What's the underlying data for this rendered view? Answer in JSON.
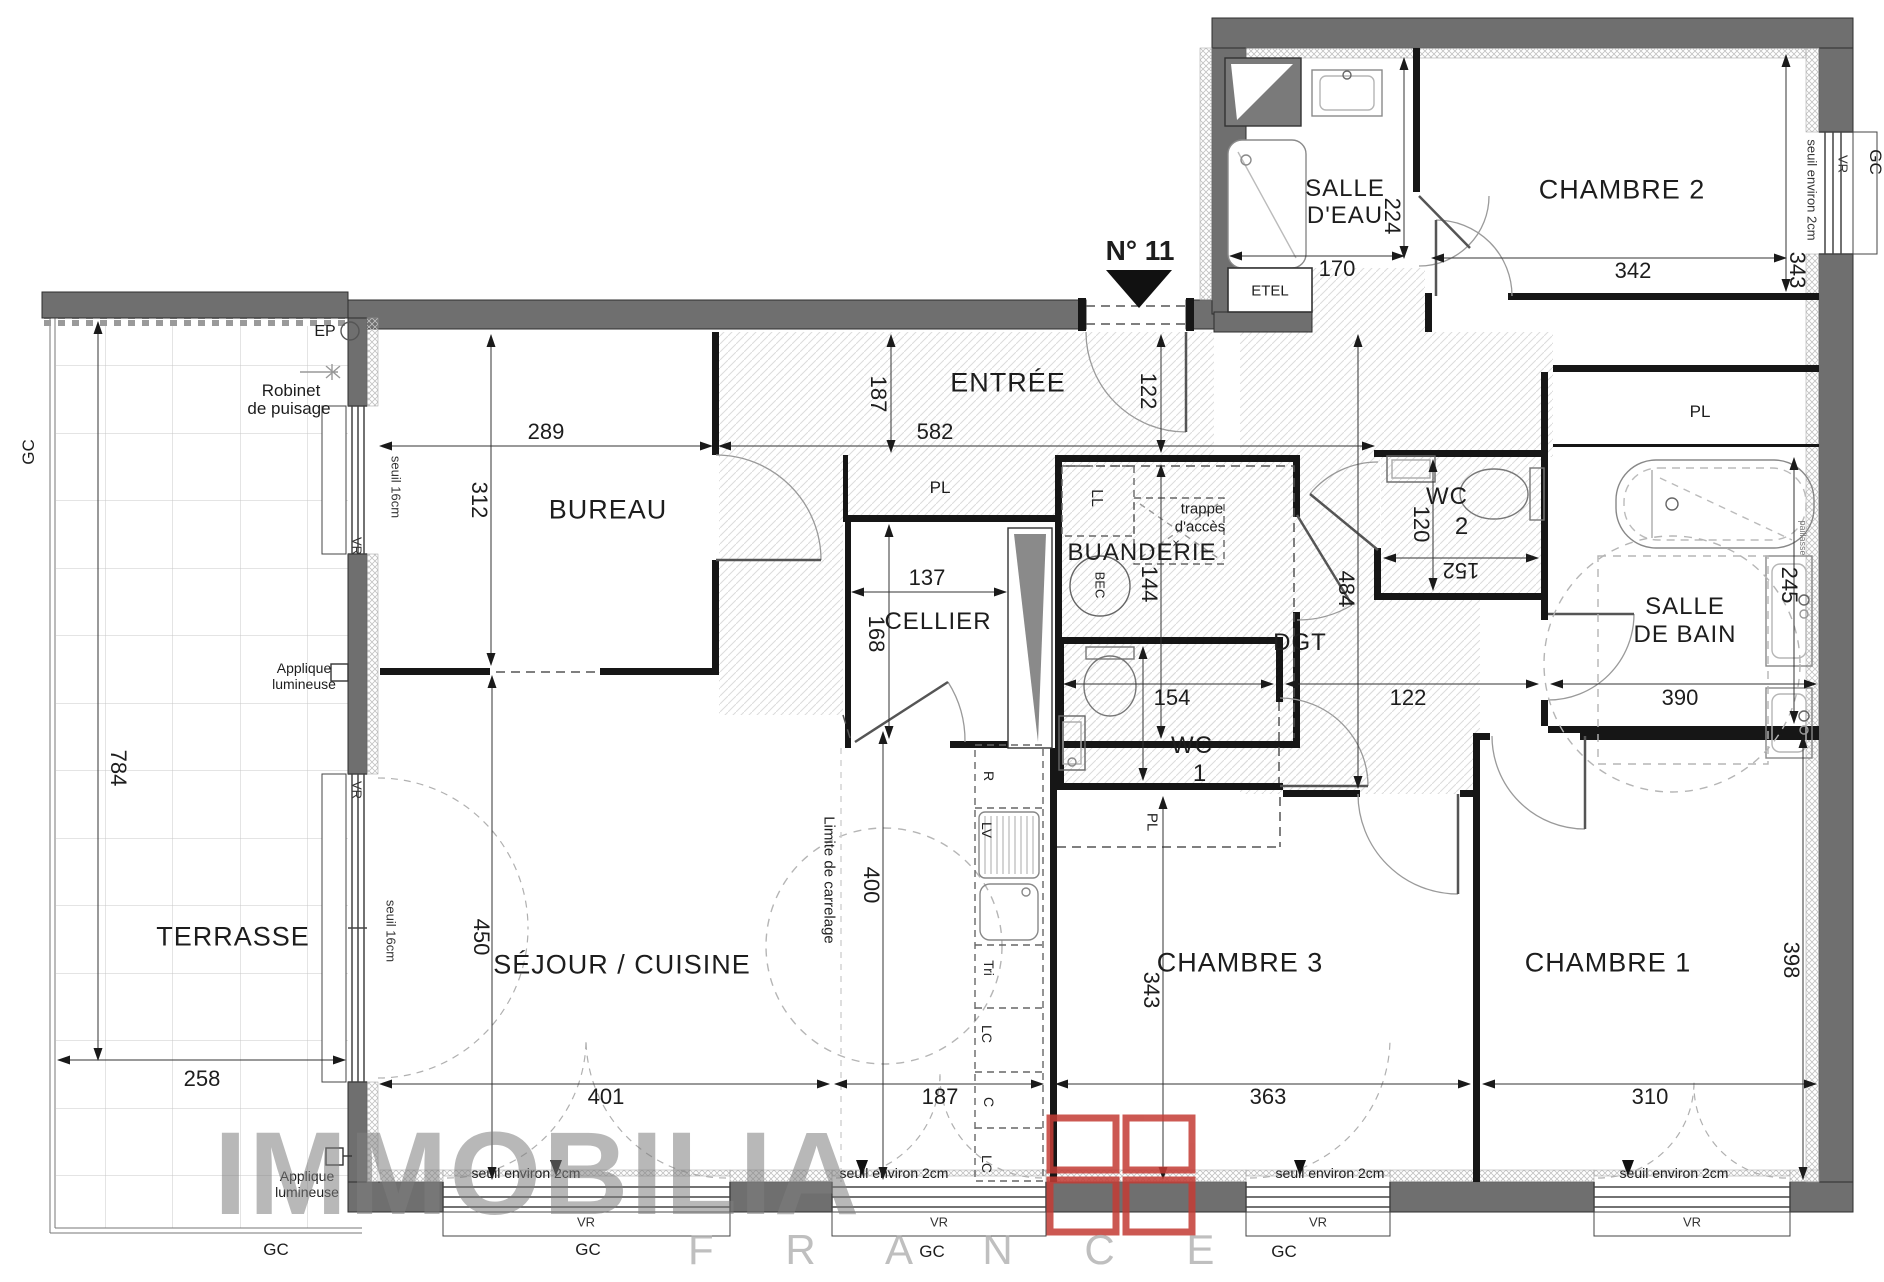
{
  "title": {
    "unit": "N° 11"
  },
  "watermark": {
    "brand": "IMMOBILIA",
    "country": "F R A N C E",
    "logo_color": "#c43c35"
  },
  "colors": {
    "exterior_wall": "#6f6f6f",
    "interior_wall": "#161616",
    "hatch_line": "#d8d8d8",
    "accent_red": "#c43c35"
  },
  "rooms": {
    "terrasse": "TERRASSE",
    "bureau": "BUREAU",
    "entree": "ENTRÉE",
    "sejour": "SÉJOUR / CUISINE",
    "cellier": "CELLIER",
    "buanderie": "BUANDERIE",
    "wc": "WC",
    "wc1_n": "1",
    "wc2_n": "2",
    "dgt": "DGT",
    "sdb_l1": "SALLE",
    "sdb_l2": "DE BAIN",
    "sde_l1": "SALLE",
    "sde_l2": "D'EAU",
    "chambre1": "CHAMBRE 1",
    "chambre2": "CHAMBRE 2",
    "chambre3": "CHAMBRE 3"
  },
  "closets": {
    "pl": "PL",
    "etel": "ETEL"
  },
  "appliances": {
    "ll": "LL",
    "bec": "BEC",
    "r": "R",
    "lv": "LV",
    "tri": "Tri",
    "lc": "LC",
    "c": "C"
  },
  "annotations": {
    "ep": "EP",
    "robinet_l1": "Robinet",
    "robinet_l2": "de puisage",
    "applique_l1": "Applique",
    "applique_l2": "lumineuse",
    "seuil16": "seuil 16cm",
    "seuil2": "seuil environ 2cm",
    "vr": "VR",
    "gc": "GC",
    "trappe_l1": "trappe",
    "trappe_l2": "d'accès",
    "trappe_x": "×",
    "limite": "Limite de carrelage",
    "paillasse": "paillasse"
  },
  "dimensions": {
    "d224": "224",
    "d170": "170",
    "d342": "342",
    "d343a": "343",
    "d289": "289",
    "d312": "312",
    "d187a": "187",
    "d582": "582",
    "d122a": "122",
    "d137": "137",
    "d168": "168",
    "d144": "144",
    "d120": "120",
    "d152": "152",
    "d484": "484",
    "d154": "154",
    "d122b": "122",
    "d245": "245",
    "d390": "390",
    "d784": "784",
    "d258": "258",
    "d450": "450",
    "d400": "400",
    "d343b": "343",
    "d398": "398",
    "d401": "401",
    "d187b": "187",
    "d363": "363",
    "d310": "310"
  }
}
